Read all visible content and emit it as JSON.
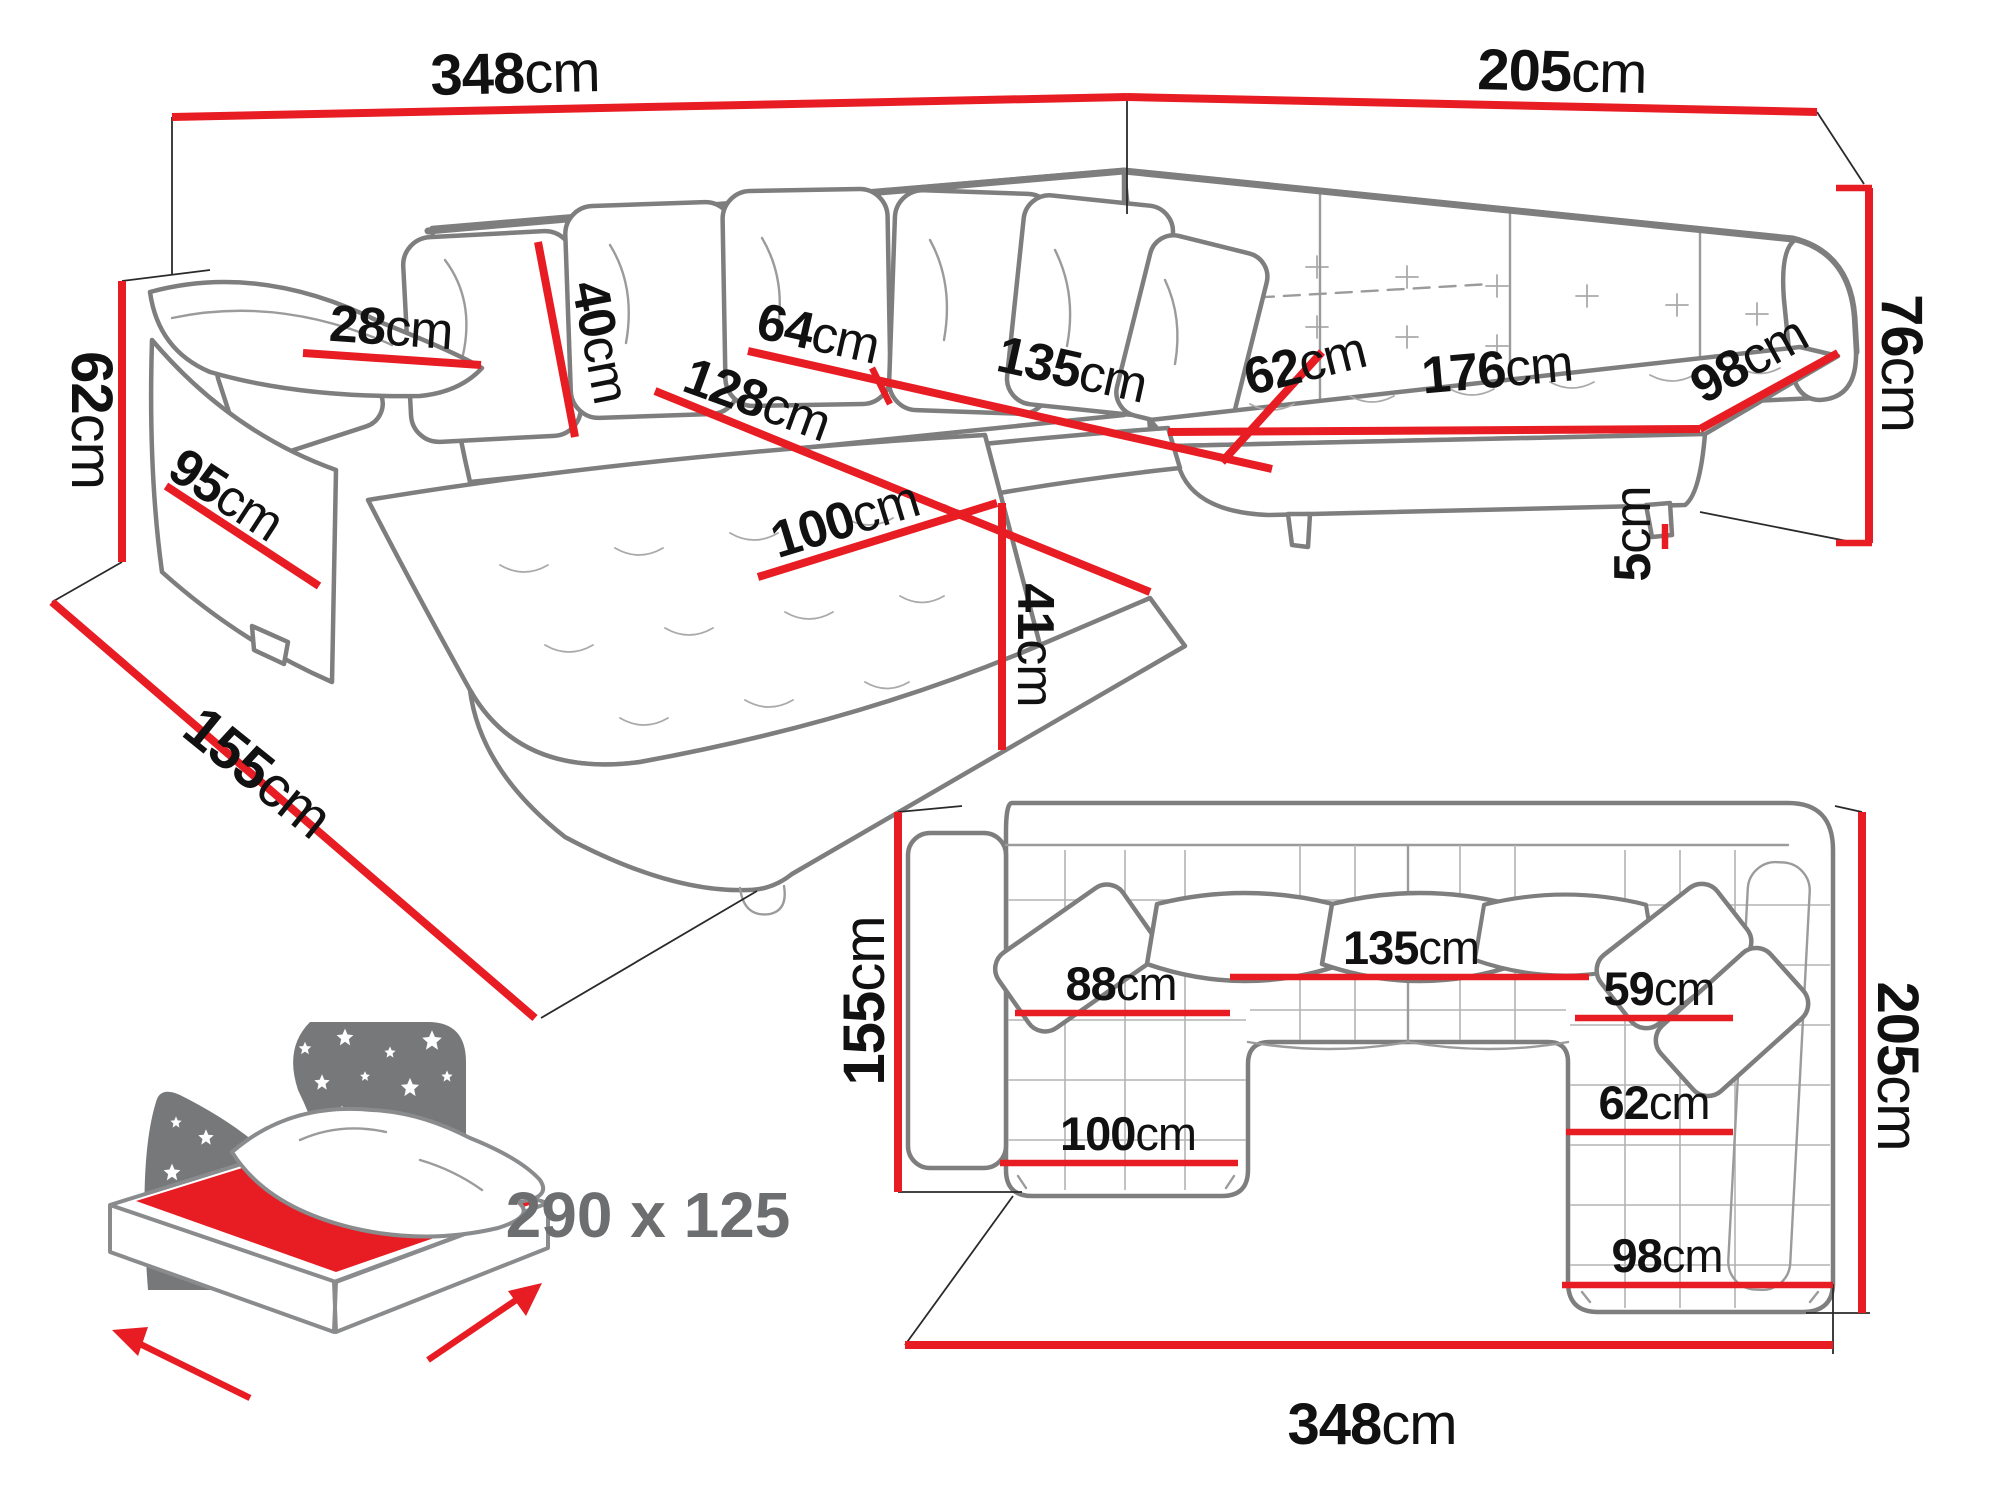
{
  "diagram_title": "corner-sofa-bed-dimensions",
  "units": "cm",
  "colors": {
    "dimension_red": "#e81c23",
    "outline_gray": "#7e7e7e",
    "text_black": "#111111",
    "icon_gray": "#77787a",
    "bed_size_text_gray": "#6d6e70"
  },
  "perspective_view": {
    "dims": [
      {
        "id": "total-width-back",
        "value": "348",
        "unit": "cm"
      },
      {
        "id": "total-depth-right",
        "value": "205",
        "unit": "cm"
      },
      {
        "id": "back-height",
        "value": "76",
        "unit": "cm"
      },
      {
        "id": "arm-height",
        "value": "62",
        "unit": "cm"
      },
      {
        "id": "chaise-total-depth",
        "value": "155",
        "unit": "cm"
      },
      {
        "id": "arm-base-depth",
        "value": "95",
        "unit": "cm"
      },
      {
        "id": "arm-top-width",
        "value": "28",
        "unit": "cm"
      },
      {
        "id": "back-cushion-height",
        "value": "40",
        "unit": "cm"
      },
      {
        "id": "seat-depth-middle",
        "value": "64",
        "unit": "cm"
      },
      {
        "id": "middle-seat-width",
        "value": "135",
        "unit": "cm"
      },
      {
        "id": "chaise-seat-length",
        "value": "128",
        "unit": "cm"
      },
      {
        "id": "chaise-seat-width",
        "value": "100",
        "unit": "cm"
      },
      {
        "id": "seat-height",
        "value": "41",
        "unit": "cm"
      },
      {
        "id": "corner-seat-depth",
        "value": "62",
        "unit": "cm"
      },
      {
        "id": "right-seat-length",
        "value": "176",
        "unit": "cm"
      },
      {
        "id": "right-end-seat-width",
        "value": "98",
        "unit": "cm"
      },
      {
        "id": "leg-height",
        "value": "5",
        "unit": "cm"
      }
    ]
  },
  "plan_view": {
    "dims": [
      {
        "id": "plan-left-depth",
        "value": "155",
        "unit": "cm"
      },
      {
        "id": "plan-right-depth",
        "value": "205",
        "unit": "cm"
      },
      {
        "id": "plan-total-width",
        "value": "348",
        "unit": "cm"
      },
      {
        "id": "plan-left-seat-width",
        "value": "88",
        "unit": "cm"
      },
      {
        "id": "plan-middle-seat-width",
        "value": "135",
        "unit": "cm"
      },
      {
        "id": "plan-right-seat-width-back",
        "value": "59",
        "unit": "cm"
      },
      {
        "id": "plan-right-seat-width-mid",
        "value": "62",
        "unit": "cm"
      },
      {
        "id": "plan-chaise-width",
        "value": "100",
        "unit": "cm"
      },
      {
        "id": "plan-right-chaise-width",
        "value": "98",
        "unit": "cm"
      }
    ]
  },
  "sofa_bed": {
    "sleeping_area": "290 x 125"
  }
}
